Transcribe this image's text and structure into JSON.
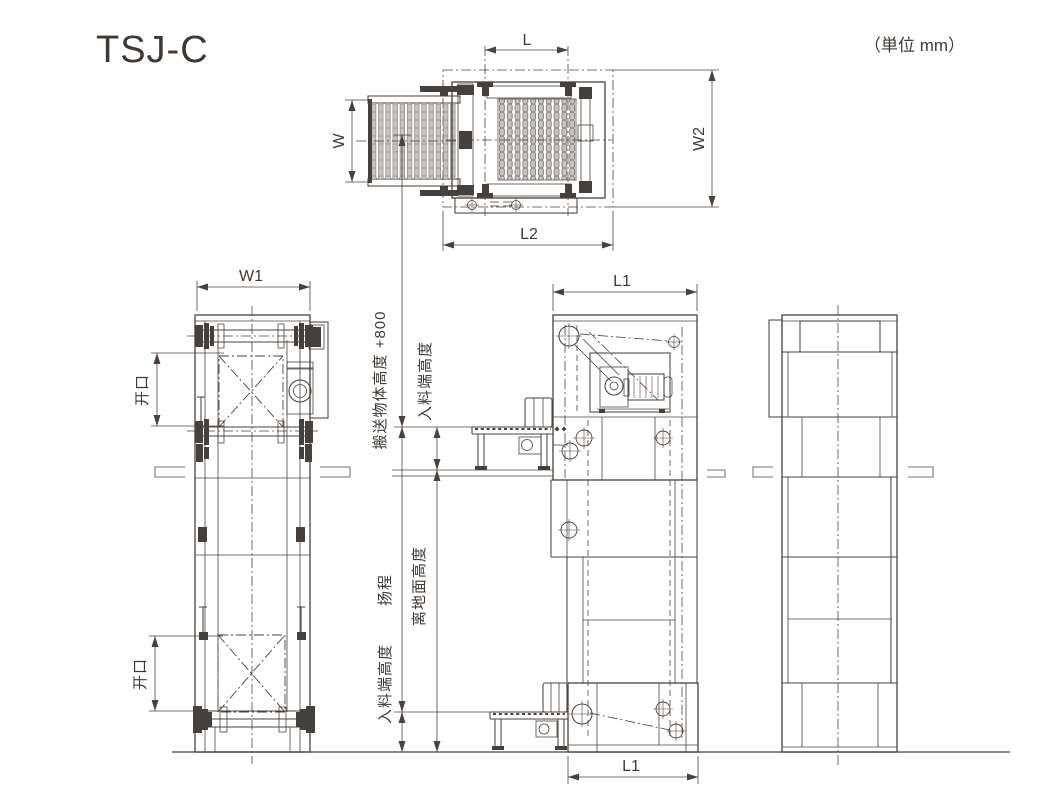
{
  "title": "TSJ-C",
  "unit_note": "（単位 mm）",
  "views": {
    "top": {
      "dims": {
        "l": "L",
        "w": "W",
        "w2": "W2",
        "l2": "L2"
      }
    },
    "front": {
      "dims": {
        "w1": "W1",
        "opening_upper": "开口",
        "opening_lower": "开口"
      }
    },
    "side": {
      "dims": {
        "l1_top": "L1",
        "l1_bottom": "L1",
        "conveyed_height": "搬送物体高度 +800",
        "infeed_upper": "入料端高度",
        "lift": "扬程",
        "floor_height": "离地面高度",
        "infeed_lower": "入料端高度"
      }
    }
  },
  "colors": {
    "line": "#4a413c",
    "roller": "#c7c3c0",
    "background": "#ffffff"
  }
}
